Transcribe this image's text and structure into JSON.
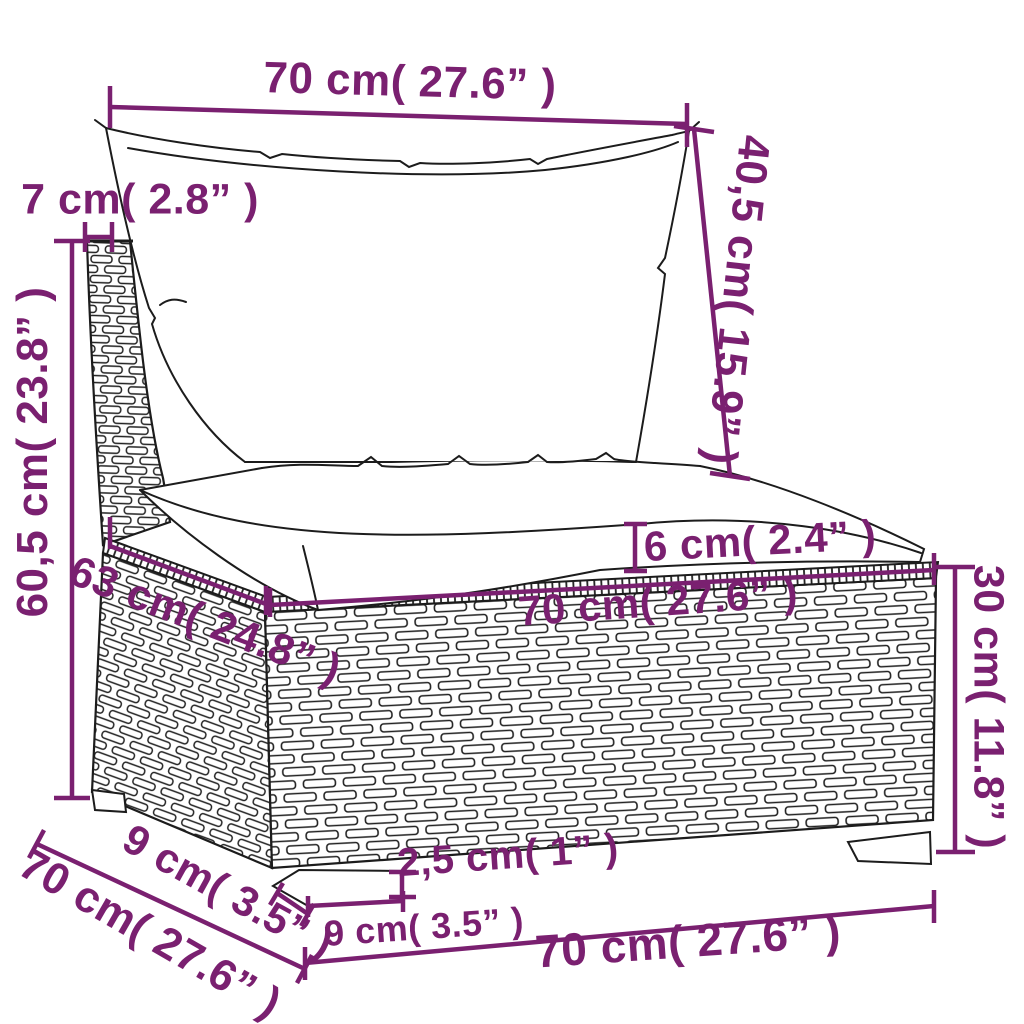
{
  "title": "Sectional sofa piece dimension diagram",
  "colors": {
    "dimension_accent": "#7a2070",
    "line_art": "#1c1c1c",
    "background": "#ffffff"
  },
  "dimensions": [
    {
      "id": "back-width",
      "label": "70 cm( 27.6” )"
    },
    {
      "id": "back-panel-thickness",
      "label": "7 cm( 2.8” )"
    },
    {
      "id": "back-cushion-height",
      "label": "40,5 cm( 15.9” )"
    },
    {
      "id": "total-height",
      "label": "60,5 cm( 23.8” )"
    },
    {
      "id": "seat-depth",
      "label": "63 cm( 24.8” )"
    },
    {
      "id": "seat-width",
      "label": "70 cm( 27.6” )"
    },
    {
      "id": "seat-cushion-thickness",
      "label": "6 cm( 2.4” )"
    },
    {
      "id": "base-height",
      "label": "30 cm( 11.8” )"
    },
    {
      "id": "leg-height",
      "label": "2,5 cm( 1” )"
    },
    {
      "id": "leg-depth-side",
      "label": "9 cm( 3.5” )"
    },
    {
      "id": "leg-width-front",
      "label": "9 cm( 3.5” )"
    },
    {
      "id": "base-depth",
      "label": "70 cm( 27.6” )"
    },
    {
      "id": "base-width",
      "label": "70 cm( 27.6” )"
    }
  ]
}
